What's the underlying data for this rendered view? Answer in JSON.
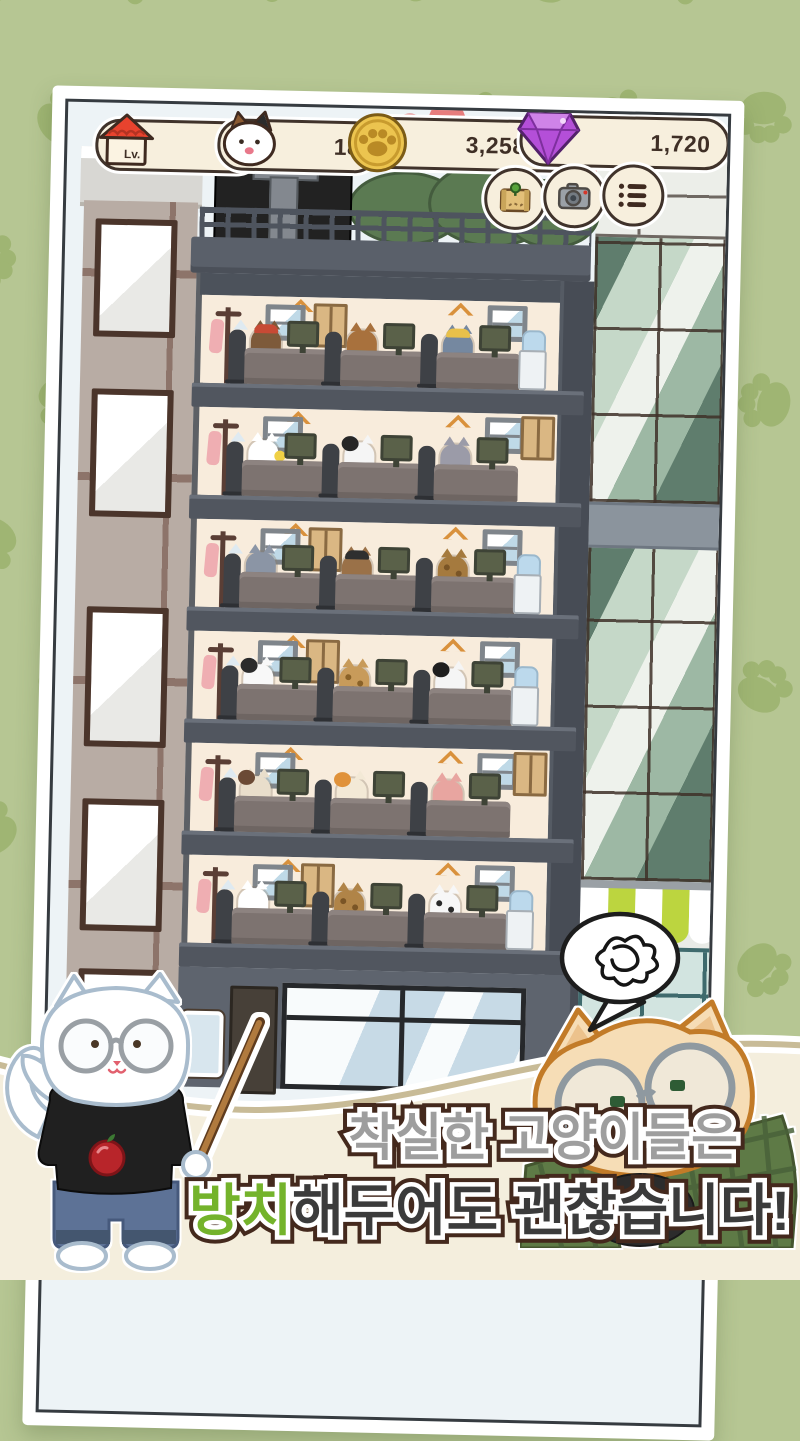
{
  "hud": {
    "level": {
      "label": "Lv.",
      "value": "6",
      "icon": "house-icon"
    },
    "cat_count": {
      "value": "18",
      "icon": "cat-icon"
    },
    "coins": {
      "value": "3,258,000",
      "icon": "paw-coin-icon"
    },
    "gems": {
      "value": "1,720",
      "icon": "gem-icon"
    },
    "buttons": [
      {
        "id": "map",
        "icon": "map-icon"
      },
      {
        "id": "camera",
        "icon": "camera-icon"
      },
      {
        "id": "list",
        "icon": "list-icon"
      }
    ]
  },
  "caption": {
    "line1": "착실한 고양이들은",
    "line2_highlight": "방치",
    "line2_rest": "해두어도 괜찮습니다!",
    "line1_color": "#9e9e9e",
    "line2_color": "#3b3b3b",
    "highlight_color": "#74b32b",
    "outline_color": "#44291d"
  },
  "speech_bubble": {
    "icon": "scribble-icon"
  },
  "building": {
    "floors": [
      {
        "cats": [
          {
            "body": "#7d5a3a",
            "accent": "cap",
            "accent_color": "#c74a35"
          },
          {
            "body": "#a8713d",
            "accent": "shirt",
            "accent_color": "#8a9a4a"
          },
          {
            "body": "#7588a0",
            "accent": "cap",
            "accent_color": "#e8c04a"
          }
        ],
        "water_cooler": true,
        "left_poster": true,
        "right_poster": false
      },
      {
        "cats": [
          {
            "body": "#ffffff",
            "accent": "item",
            "accent_color": "#f0d045"
          },
          {
            "body": "#f5f5f5",
            "accent": "head",
            "accent_color": "#262626"
          },
          {
            "body": "#9b9ba8",
            "accent": "none",
            "accent_color": ""
          }
        ],
        "water_cooler": false,
        "left_poster": false,
        "right_poster": true
      },
      {
        "cats": [
          {
            "body": "#8b95a5",
            "accent": "none",
            "accent_color": ""
          },
          {
            "body": "#9a7148",
            "accent": "cap",
            "accent_color": "#2f2f2f"
          },
          {
            "body": "#a57a3e",
            "accent": "spots",
            "accent_color": "#7a5526"
          }
        ],
        "water_cooler": true,
        "left_poster": true,
        "right_poster": false
      },
      {
        "cats": [
          {
            "body": "#f8f8f8",
            "accent": "head",
            "accent_color": "#2b2b2b"
          },
          {
            "body": "#c89b5a",
            "accent": "spots",
            "accent_color": "#8a6228"
          },
          {
            "body": "#f5f5f5",
            "accent": "head",
            "accent_color": "#1f1f1f"
          }
        ],
        "water_cooler": true,
        "left_poster": true,
        "right_poster": false
      },
      {
        "cats": [
          {
            "body": "#e9decb",
            "accent": "head",
            "accent_color": "#6b4a35"
          },
          {
            "body": "#f3e9d6",
            "accent": "head",
            "accent_color": "#e0923a"
          },
          {
            "body": "#e8a5a0",
            "accent": "shirt",
            "accent_color": "#7a9a5a"
          }
        ],
        "water_cooler": false,
        "left_poster": false,
        "right_poster": true
      },
      {
        "cats": [
          {
            "body": "#ffffff",
            "accent": "none",
            "accent_color": ""
          },
          {
            "body": "#b08448",
            "accent": "spots",
            "accent_color": "#7a5526"
          },
          {
            "body": "#f7f7f7",
            "accent": "spots",
            "accent_color": "#2a2a2a"
          }
        ],
        "water_cooler": true,
        "left_poster": true,
        "right_poster": false
      }
    ]
  },
  "colors": {
    "background": "#b6c693",
    "paw": "#9fb573",
    "badge_bg": "#f7efdd",
    "badge_border": "#40332b",
    "band_fill": "#f4eedd",
    "band_edge": "#c8bb97",
    "slab": "#51565f",
    "wall": "#f8ecdc",
    "sky": "#edf3f6",
    "accent_green": "#74b32b"
  }
}
